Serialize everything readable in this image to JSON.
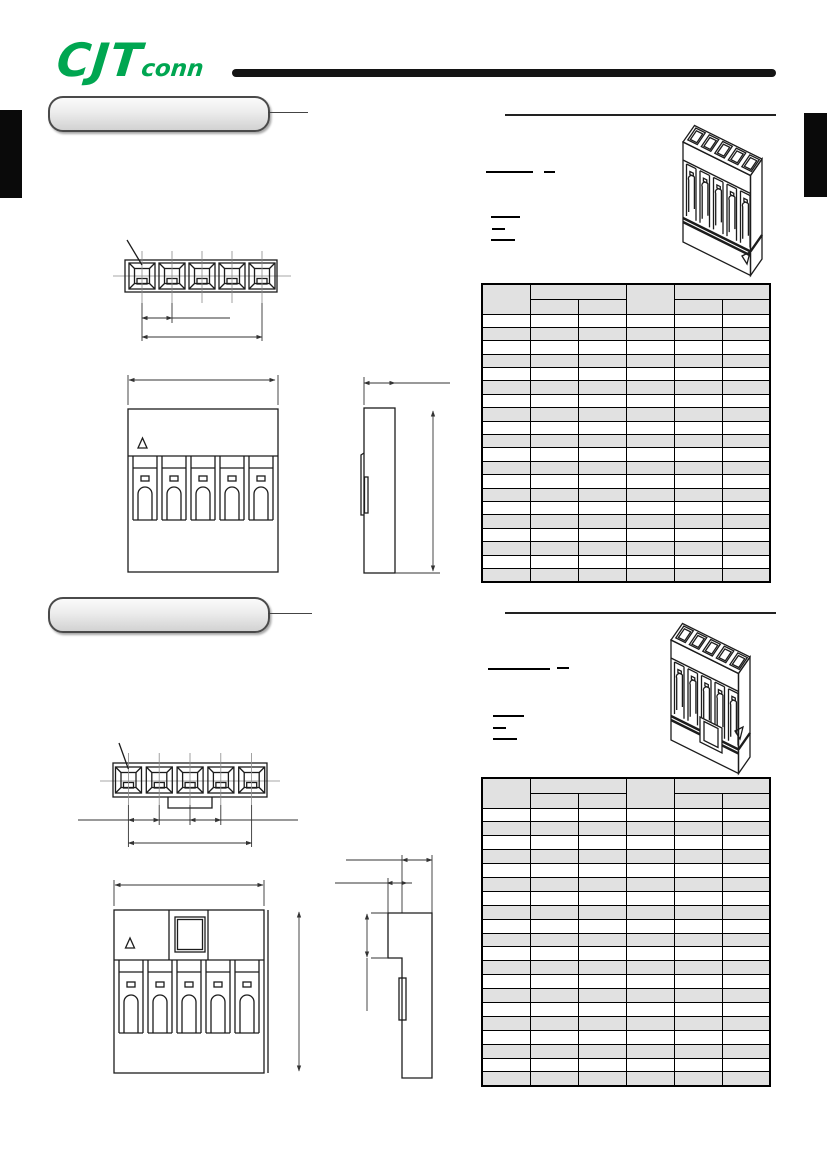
{
  "page": {
    "background": "#ffffff",
    "kind": "connector-datasheet-scan"
  },
  "brand": {
    "logo_main": "CJT",
    "logo_sub": "conn",
    "logo_color": "#00A651"
  },
  "colors": {
    "accent_green": "#00A651",
    "header_bar": "#141414",
    "table_border": "#000000",
    "table_header_bg": "#e1e1e1",
    "table_alt_row_bg": "#e1e1e1",
    "table_row_bg": "#ffffff",
    "pill_border": "#4a4a4a",
    "edge_tab": "#0a0a0a",
    "drawing_stroke": "#1c1c1c"
  },
  "sections": [
    {
      "pill_label": "",
      "note_underline_count": 5,
      "table": {
        "columns": 6,
        "header_rows": 2,
        "merged_header_columns": [
          [
            1
          ],
          [
            2,
            3
          ],
          [
            4
          ],
          [
            5,
            6
          ]
        ],
        "data_rows": 20,
        "cells_blank": true
      },
      "drawings": {
        "positions": 5,
        "top_view": true,
        "front_view": true,
        "side_view": true,
        "isometric_view": true,
        "latch_window": false
      }
    },
    {
      "pill_label": "",
      "note_underline_count": 5,
      "table": {
        "columns": 6,
        "header_rows": 2,
        "merged_header_columns": [
          [
            1
          ],
          [
            2,
            3
          ],
          [
            4
          ],
          [
            5,
            6
          ]
        ],
        "data_rows": 20,
        "cells_blank": true
      },
      "drawings": {
        "positions": 5,
        "top_view": true,
        "front_view": true,
        "side_view": true,
        "isometric_view": true,
        "latch_window": true
      }
    }
  ]
}
